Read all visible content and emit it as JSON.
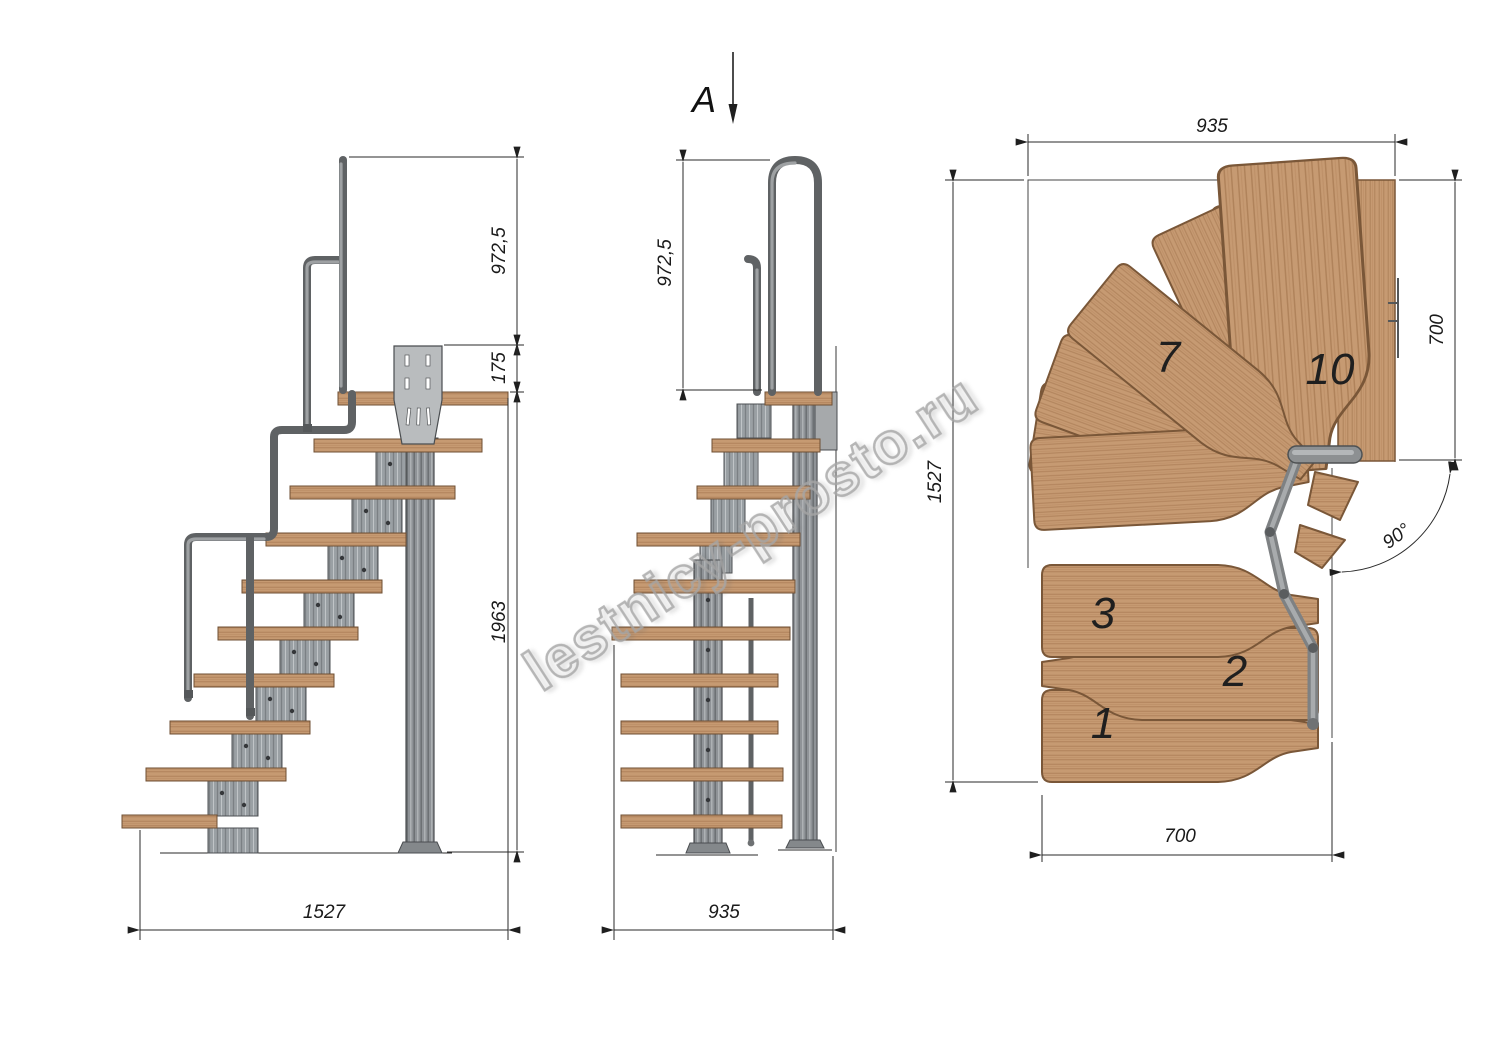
{
  "drawing": {
    "watermark": "lestnicy-prosto.ru",
    "side_view": {
      "dim_rail_height": "972,5",
      "dim_platform_drop": "175",
      "dim_total_height": "1963",
      "dim_total_run": "1527"
    },
    "front_view": {
      "section_label": "A",
      "dim_rail_height": "972,5",
      "dim_width": "935"
    },
    "plan_view": {
      "dim_width_top": "935",
      "dim_depth_left": "1527",
      "dim_landing_right": "700",
      "dim_width_bottom": "700",
      "dim_turn_angle": "90°",
      "tread_labels": {
        "t1": "1",
        "t2": "2",
        "t3": "3",
        "t7": "7",
        "t10": "10"
      }
    },
    "colors": {
      "background": "#ffffff",
      "wood": "#c69a72",
      "wood_edge": "#7a5738",
      "metal": "#8f9397",
      "metal_edge": "#4e5154",
      "dim_line": "#2a2a2a",
      "watermark": "#a5a5a5"
    }
  }
}
